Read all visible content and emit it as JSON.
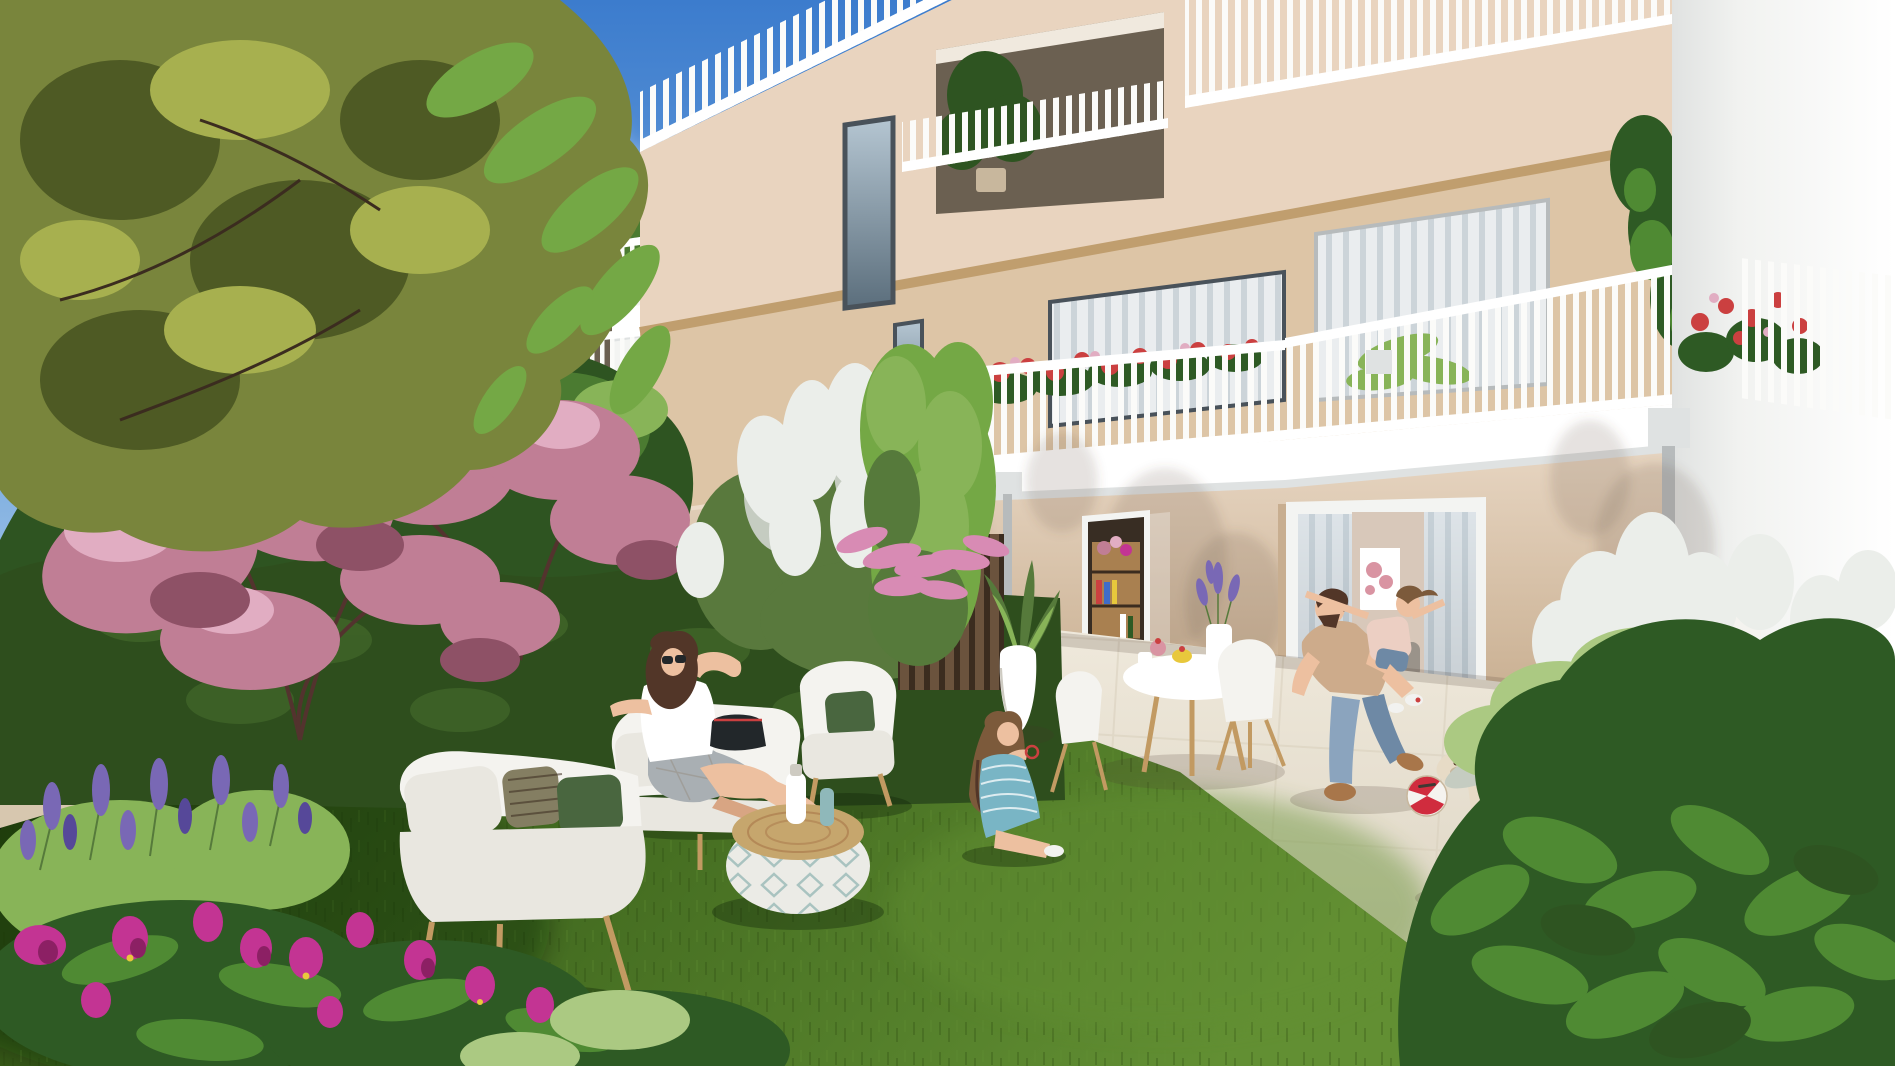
{
  "palette": {
    "sky_top": "#3c7ccd",
    "sky_mid": "#79abdf",
    "sky_low": "#c6dbf0",
    "cloud": "#f8fbfd",
    "white_wall": "#f3f4f2",
    "white_bright": "#ffffff",
    "white_shade": "#dfe2e2",
    "facade_light": "#ecdcca",
    "facade_top": "#e9d4bf",
    "facade_mid": "#ddc5a6",
    "facade_shadow": "#c8ae90",
    "slab_tan": "#c09e6e",
    "loggia_dark": "#6b6051",
    "loggia_ceiling": "#f0e9de",
    "railing_white": "#fbfbf9",
    "railing_bar": "#f4f5f4",
    "railing_shadow": "#b7bbbc",
    "window_frame": "#49525a",
    "glass_top": "#b5c6d2",
    "glass_bottom": "#5b6e7c",
    "curtain": "#eaedef",
    "blind_stripe": "#ccd4d9",
    "glass_reflect": "rgba(255,255,255,0.28)",
    "end_wall": "#f1f2f0",
    "end_wall_edge": "#e0e2e1",
    "grass_light": "#628f33",
    "grass_mid": "#41691f",
    "grass_dark": "#2a470f",
    "patio": "#f0eadd",
    "patio_line": "#d8cfbc",
    "gravel": "#d7c7af",
    "tree_olive": "#79853c",
    "tree_olive_dark": "#4e5a24",
    "tree_olive_light": "#a7b04f",
    "tree_fresh": "#74a845",
    "tree_green": "#4b7b31",
    "tree_green_dark": "#2e5421",
    "tree_green_light": "#88b458",
    "hedge": "#2e4e1d",
    "hedge_light": "#4b7330",
    "blossom": "#c07e95",
    "blossom_light": "#e1adc2",
    "blossom_dark": "#8e5166",
    "branch": "#53332e",
    "lilac_white": "#ebeeea",
    "lilac_shadow": "#c5ccc1",
    "lilac_green": "#59793d",
    "magenta": "#c33493",
    "magenta_dark": "#8c2064",
    "leaf_glossy": "#2e5a24",
    "leaf_glossy_light": "#4f8a33",
    "leaf_pale": "#abc982",
    "lavender": "#7968b5",
    "lavender_dark": "#564899",
    "stem_green": "#567a3b",
    "wood_fence": "#6b533d",
    "wood_fence_dark": "#3b2c1f",
    "furniture_white": "#f4f3ef",
    "cushion": "#e9e7e0",
    "cushion_shadow": "#cecbc2",
    "pillow_green": "#49663f",
    "pillow_olive": "#847e62",
    "wood_leg": "#c29a62",
    "pouf_top": "#c6a66d",
    "pouf_body": "#ebebe6",
    "pouf_teal": "#a2bfbc",
    "bottle_teal": "#8fb8ba",
    "skin": "#edc0a0",
    "skin_shadow": "#d8a583",
    "hair_brown": "#523628",
    "hair_light": "#7c5a3b",
    "jeans": "#8ba4be",
    "jeans_dark": "#6e89a5",
    "tan_shirt": "#cdab8b",
    "teal_dress": "#79b5c5",
    "skirt_gray": "#a9afb3",
    "girl_top": "#eccfc3",
    "boot_tan": "#a8764a",
    "shoe_white": "#f2f2f0",
    "ball_red": "#d02c3e",
    "ball_white": "#f5f3ef",
    "horse_wood": "#e7dbc6",
    "horse_shadow": "#c8b79d",
    "interior_dark": "#382d23",
    "interior_wall": "#d8c8ba",
    "book_wood": "#a98050",
    "salmon": "#eaa98b",
    "sofa_gray": "#9a938a",
    "art_pink": "#d994a2",
    "accent_red": "#cb4040",
    "accent_yellow": "#e8c83c",
    "accent_blue": "#3f6cc8",
    "table_dark": "#3e3933",
    "bag_dark": "#22272a",
    "shadow_soft": "rgba(70,58,45,0.18)",
    "shadow_green": "rgba(15,35,8,0.35)",
    "shadow_wall": "rgba(100,82,64,0.16)",
    "heather_pink": "#d88bb4",
    "geranium_red": "#cc4450"
  }
}
